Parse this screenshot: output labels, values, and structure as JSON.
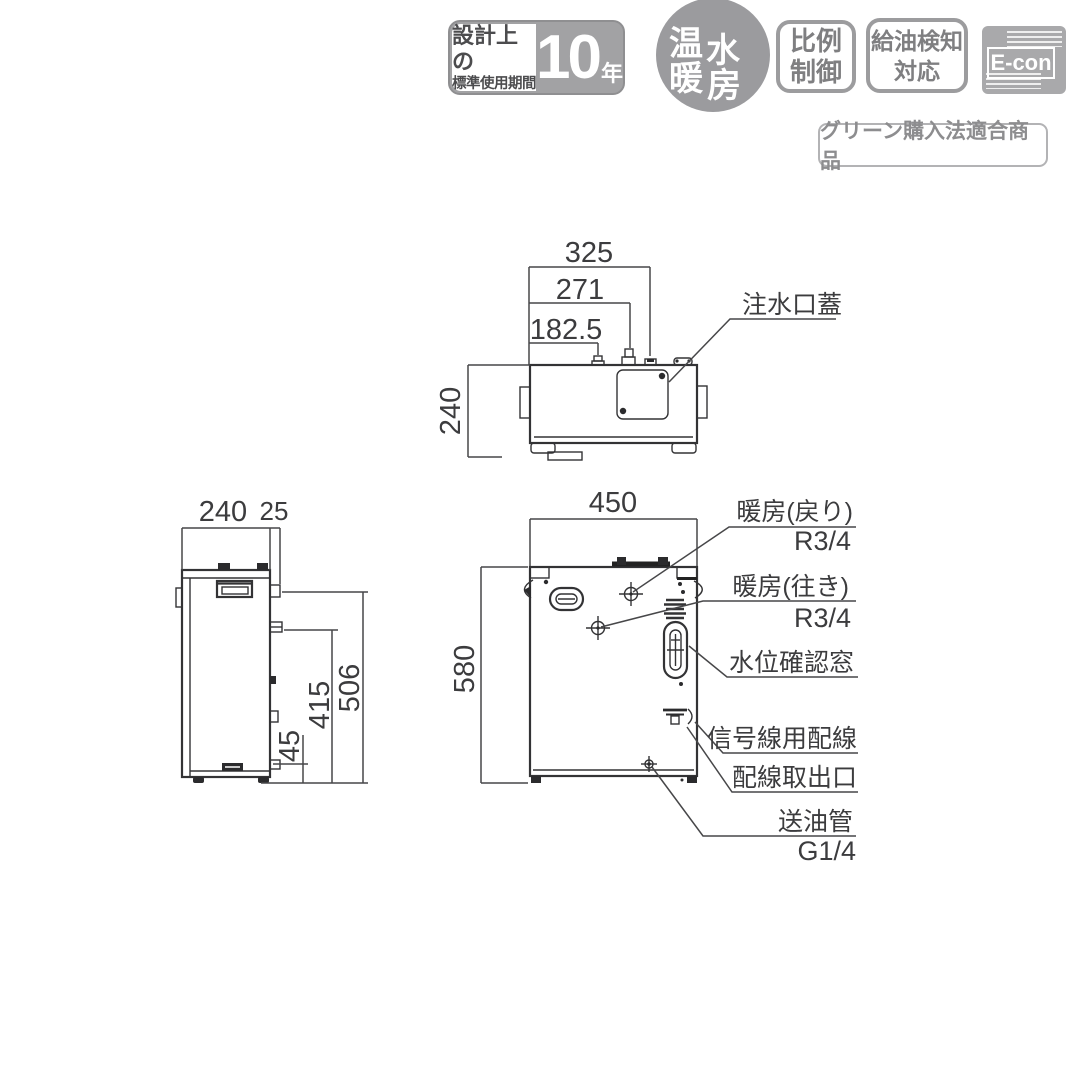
{
  "badges": {
    "design_life": {
      "line1": "設計上の",
      "line2": "標準使用期間",
      "value": "10",
      "unit": "年"
    },
    "hot_water_heating": {
      "char1": "温",
      "char2": "水",
      "char3": "暖",
      "char4": "房"
    },
    "proportional_control": {
      "line1": "比例",
      "line2": "制御"
    },
    "oil_detection": {
      "line1": "給油検知",
      "line2": "対応"
    },
    "econ": "E-con",
    "green_procurement": "グリーン購入法適合商品"
  },
  "top_view": {
    "dim_325": "325",
    "dim_271": "271",
    "dim_182_5": "182.5",
    "dim_240": "240",
    "water_inlet_cover": "注水口蓋"
  },
  "side_view": {
    "dim_240": "240",
    "dim_25": "25",
    "dim_506": "506",
    "dim_415": "415",
    "dim_45": "45"
  },
  "front_view": {
    "dim_450": "450",
    "dim_580": "580",
    "heating_return": "暖房(戻り)",
    "heating_return_size": "R3/4",
    "heating_supply": "暖房(往き)",
    "heating_supply_size": "R3/4",
    "water_level_window": "水位確認窓",
    "signal_wiring": "信号線用配線",
    "wiring_outlet": "配線取出口",
    "oil_supply_pipe": "送油管",
    "oil_supply_pipe_size": "G1/4"
  },
  "colors": {
    "line": "#333335",
    "badge_gray": "#9b9b9e",
    "badge_text": "#7f7f81"
  }
}
